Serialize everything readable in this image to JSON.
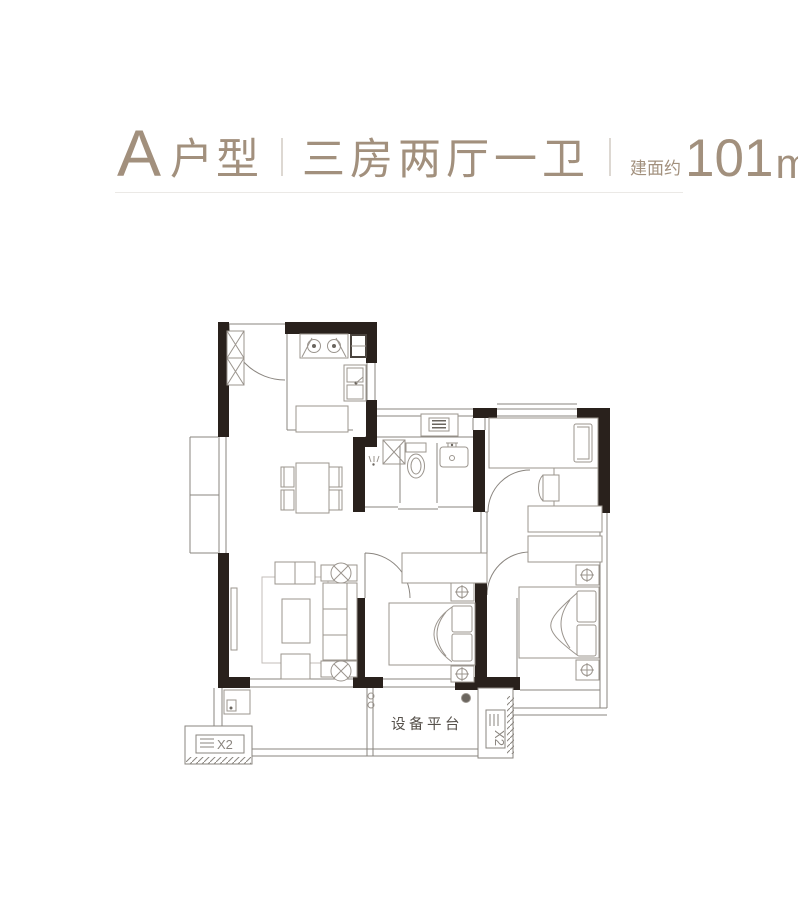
{
  "header": {
    "unit": "A",
    "unit_type": "户型",
    "layout": "三房两厅一卫",
    "area_prefix": "建面约",
    "area_value": "101",
    "area_unit": "m",
    "area_exponent": "2"
  },
  "floorplan": {
    "equipment_platform_label": "设备平台",
    "ac_left_label": "X2",
    "ac_right_label": "X2"
  },
  "colors": {
    "header_text": "#a2907d",
    "wall": "#29211c",
    "line": "#8a857f",
    "furniture_line": "#9b958e",
    "rug": "#c3beb8",
    "label_text": "#55504a",
    "divider": "#ddd8d2",
    "separator": "#ebe9e6"
  }
}
